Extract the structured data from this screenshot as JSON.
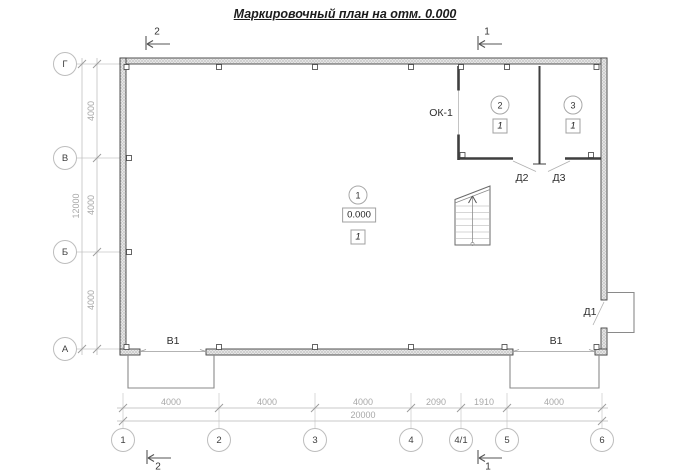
{
  "title": "Маркировочный план на отм. 0.000",
  "axes": {
    "vertical": [
      "Г",
      "В",
      "Б",
      "А"
    ],
    "horizontal": [
      "1",
      "2",
      "3",
      "4",
      "4/1",
      "5",
      "6"
    ]
  },
  "dimensions": {
    "left": {
      "segments": [
        "4000",
        "4000",
        "4000"
      ],
      "total": "12000"
    },
    "bottom": {
      "segments": [
        "4000",
        "4000",
        "4000",
        "2090",
        "1910",
        "4000"
      ],
      "total": "20000"
    }
  },
  "rooms": [
    {
      "number": "1",
      "floor_type": "1",
      "elevation": "0.000"
    },
    {
      "number": "2",
      "floor_type": "1"
    },
    {
      "number": "3",
      "floor_type": "1"
    }
  ],
  "marks": {
    "window": "ОК-1",
    "door_entry": "Д1",
    "door_room2": "Д2",
    "door_room3": "Д3",
    "gate_bottom_left": "В1",
    "gate_bottom_right": "В1"
  },
  "sections": {
    "top_left": "2",
    "top_right": "1",
    "bottom_left": "2",
    "bottom_right": "1"
  },
  "colors": {
    "wall_line": "#3f3f3f",
    "dim_line": "#b8b8b8",
    "dim_text": "#a8a8a8"
  }
}
